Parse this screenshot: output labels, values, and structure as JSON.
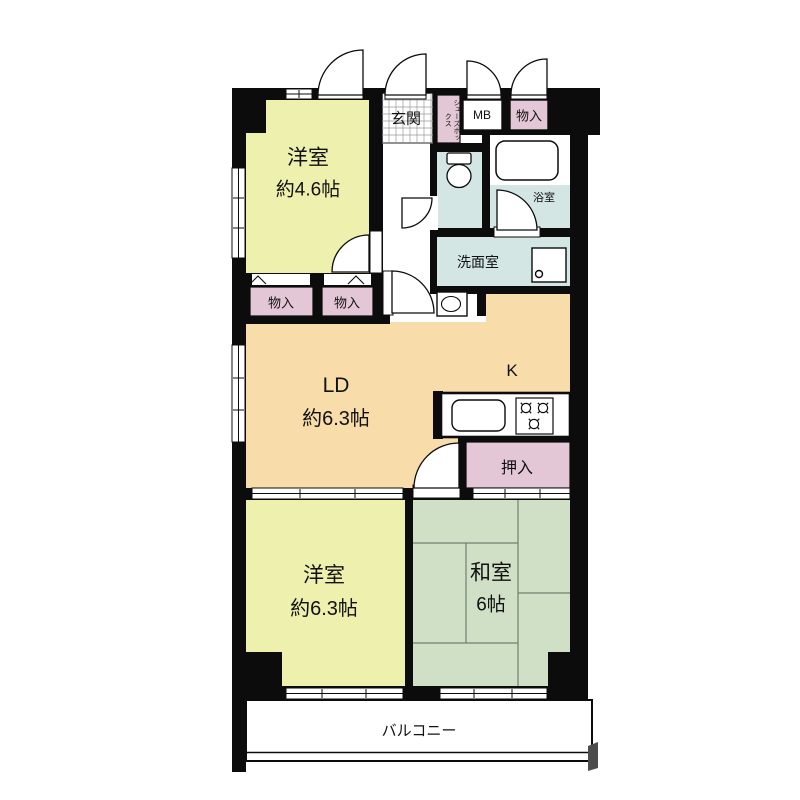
{
  "plan": {
    "type": "apartment-floor-plan",
    "colors": {
      "wall": "#0c0c0c",
      "western_room": "#eef0ae",
      "living_dining": "#f8dcaa",
      "japanese_room": "#cfe0c6",
      "storage_pink": "#e3c7d6",
      "wet_area_blue": "#d3e6e3",
      "balcony_shadow": "#4d4d4d",
      "tile_line": "#9a9a9a",
      "tatami_line": "#6f7f6f"
    },
    "rooms": {
      "western_small": {
        "name": "洋室",
        "size": "約4.6帖"
      },
      "entrance": {
        "name": "玄関"
      },
      "shoe_box": {
        "name": "シューズボックス"
      },
      "meter_box": {
        "name": "MB"
      },
      "storage_top": {
        "name": "物入"
      },
      "bathroom": {
        "name": "浴室"
      },
      "washroom": {
        "name": "洗面室"
      },
      "storage_a": {
        "name": "物入"
      },
      "storage_b": {
        "name": "物入"
      },
      "living_dining": {
        "name": "LD",
        "size": "約6.3帖"
      },
      "kitchen": {
        "name": "K"
      },
      "closet": {
        "name": "押入"
      },
      "western_large": {
        "name": "洋室",
        "size": "約6.3帖"
      },
      "japanese": {
        "name": "和室",
        "size": "6帖"
      },
      "balcony": {
        "name": "バルコニー"
      }
    }
  }
}
